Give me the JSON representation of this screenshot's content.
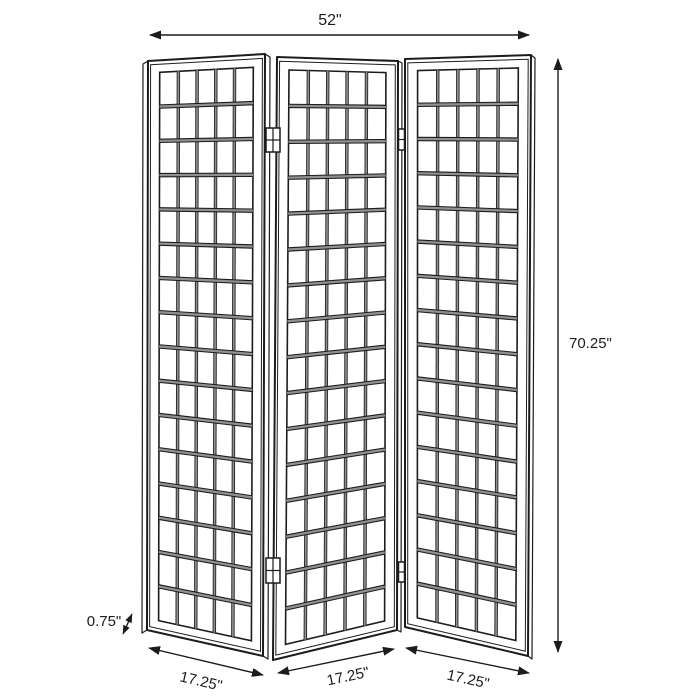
{
  "diagram": {
    "type": "product-dimension-diagram",
    "subject": "3-panel folding room divider screen with grid lattice panels",
    "panel_count": 3,
    "grid_columns_per_panel": 5,
    "grid_rows_per_panel": 16,
    "line_color": "#1c1c1c",
    "shade_color": "#909090",
    "background_color": "#ffffff"
  },
  "labels": {
    "width_total": "52\"",
    "height": "70.25\"",
    "thickness": "0.75\"",
    "panel_widths": [
      "17.25\"",
      "17.25\"",
      "17.25\""
    ]
  }
}
